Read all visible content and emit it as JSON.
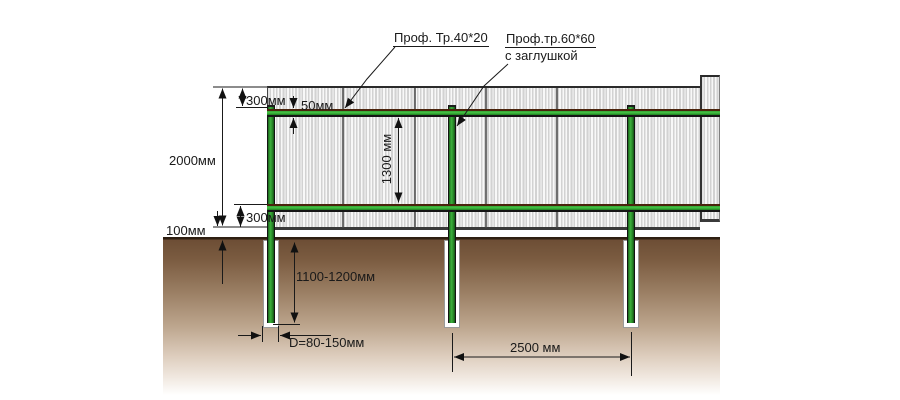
{
  "diagram": {
    "labels": {
      "rail_profile": "Проф. Тр.40*20",
      "post_profile": "Проф.тр.60*60",
      "post_profile_note": "с заглушкой"
    },
    "dimensions": {
      "sheet_top_to_rail": "300мм",
      "rail_height": "50мм",
      "fence_height": "2000мм",
      "rails_spacing": "1300 мм",
      "rail_to_sheet_bottom": "300мм",
      "ground_clearance": "100мм",
      "post_buried_depth": "1100-1200мм",
      "hole_diameter": "D=80-150мм",
      "posts_spacing": "2500 мм"
    },
    "colors": {
      "metal_green": "#2f9e2f",
      "rail_edge_brown": "#4a230c",
      "soil_brown": "#7b5c41",
      "sheet_gray": "#d9d9d9",
      "line_color": "#1a1a1a"
    }
  }
}
